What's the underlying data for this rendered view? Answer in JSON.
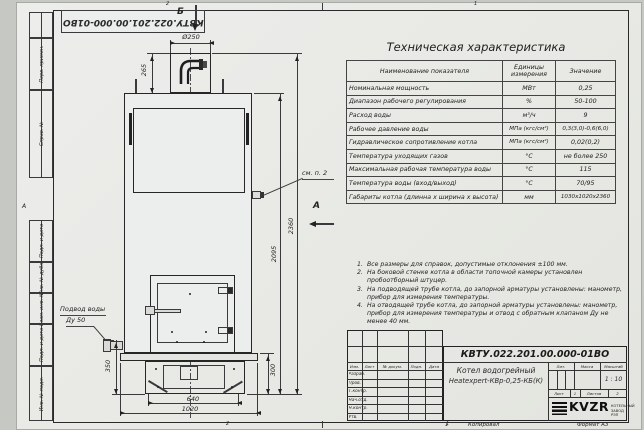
{
  "sheet": {
    "doc_number": "КВТУ.022.201.00.000-01ВО",
    "zone_2": "2",
    "zone_1": "1",
    "row_marker": "А",
    "copy_label": "Копировал",
    "format_label": "Формат А3"
  },
  "margin": {
    "perv_primen": "Перв. примен.",
    "sprav_no": "Справ. №",
    "podp_data_1": "Подп. и дата",
    "inv_dubl": "Инв. № дубл.",
    "vzam_inv": "Взам. инв. №",
    "podp_data_2": "Подп. и дата",
    "inv_podl": "Инв. № подл."
  },
  "drawing": {
    "view_b": "Б",
    "view_a": "А",
    "callout_see_p2": "см. п. 2",
    "water_inlet_line1": "Подвод воды",
    "water_inlet_line2": "Ду 50",
    "dims": {
      "d250": "Ø250",
      "h265": "265",
      "h2360": "2360",
      "h2095": "2095",
      "h350": "350",
      "h300": "300",
      "w640": "640",
      "w1020": "1020"
    }
  },
  "spec_table": {
    "title": "Техническая характеристика",
    "headers": [
      "Наименование показателя",
      "Единицы измерения",
      "Значение"
    ],
    "rows": [
      {
        "name": "Номинальная мощность",
        "unit": "МВт",
        "value": "0,25"
      },
      {
        "name": "Диапазон рабочего регулирования",
        "unit": "%",
        "value": "50-100"
      },
      {
        "name": "Расход воды",
        "unit": "м³/ч",
        "value": "9"
      },
      {
        "name": "Рабочее давление воды",
        "unit": "МПа (кгс/см²)",
        "value": "0,3(3,0)-0,6(6,0)"
      },
      {
        "name": "Гидравлическое сопротивление котла",
        "unit": "МПа (кгс/см²)",
        "value": "0,02(0,2)"
      },
      {
        "name": "Температура уходящих газов",
        "unit": "°С",
        "value": "не более 250"
      },
      {
        "name": "Максимальная рабочая температура воды",
        "unit": "°С",
        "value": "115"
      },
      {
        "name": "Температура воды (вход/выход)",
        "unit": "°С",
        "value": "70/95"
      },
      {
        "name": "Габариты котла (длинна х ширина х высота)",
        "unit": "мм",
        "value": "1030х1020х2360"
      }
    ]
  },
  "notes": {
    "items": [
      {
        "num": "1.",
        "text": "Все размеры для справок, допустимые отклонения ±100 мм."
      },
      {
        "num": "2.",
        "text": "На боковой стенке котла в области топочной камеры установлен пробоотборный штуцер."
      },
      {
        "num": "3.",
        "text": "На подводящей трубе котла, до запорной арматуры установлены: манометр, прибор для измерения температуры."
      },
      {
        "num": "4.",
        "text": "На отводящей трубе котла, до запорной арматуры установлены: манометр, прибор для измерения температуры и отвод с обратным клапаном Ду не менее 40 мм."
      }
    ]
  },
  "title_block": {
    "doc_number": "КВТУ.022.201.00.000-01ВО",
    "product_name_line1": "Котел водогрейный",
    "product_name_line2": "Heatexpert-КВр-0,25-КБ(К)",
    "col_headers": [
      "Изм.",
      "Лист",
      "№ докум.",
      "Подп.",
      "Дата"
    ],
    "row_labels": [
      "Разраб.",
      "Пров.",
      "Т.контр.",
      "Нач.отд.",
      "Н.контр.",
      "Утв."
    ],
    "lit_label": "Лит.",
    "mass_label": "Масса",
    "scale_label": "Масштаб",
    "scale_value": "1 : 10",
    "sheet_label": "Лист",
    "sheet_value": "1",
    "sheets_label": "Листов",
    "sheets_value": "2",
    "logo_text": "KVZR",
    "logo_sub1": "КОТЕЛЬНЫЙ",
    "logo_sub2": "ЗАВОД РЭП"
  }
}
